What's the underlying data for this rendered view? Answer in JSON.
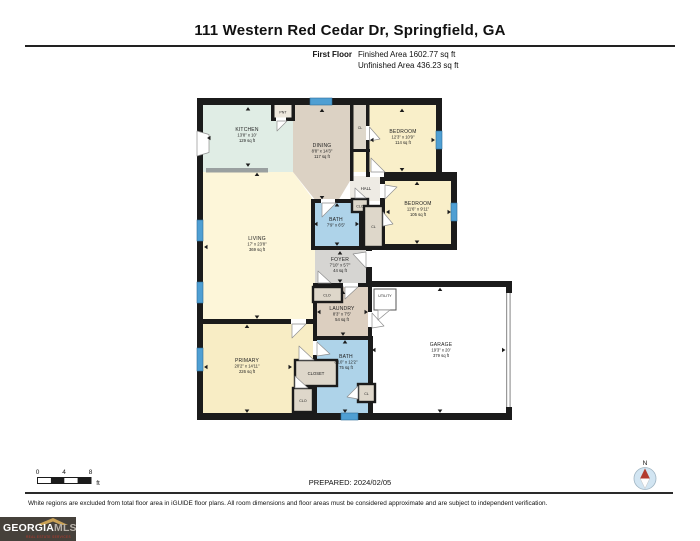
{
  "header": {
    "title": "111 Western Red Cedar Dr, Springfield, GA",
    "floor_label": "First Floor",
    "finished_area": "Finished Area 1602.77 sq ft",
    "unfinished_area": "Unfinished Area 436.23 sq ft"
  },
  "rooms": {
    "kitchen": {
      "name": "KITCHEN",
      "dims": "13'8\" x 10'",
      "area": "129 sq ft"
    },
    "pantry": {
      "name": "PNT"
    },
    "dining": {
      "name": "DINING",
      "dims": "8'8\" x 14'3\"",
      "area": "117 sq ft"
    },
    "closet_top": {
      "name": "CL"
    },
    "bedroom1": {
      "name": "BEDROOM",
      "dims": "12'3\" x 10'9\"",
      "area": "114 sq ft"
    },
    "hall": {
      "name": "HALL"
    },
    "clo_hall": {
      "name": "CLO"
    },
    "bath1": {
      "name": "BATH",
      "dims": "7'9\" x 6'5\""
    },
    "closet_bed2": {
      "name": "CL"
    },
    "bedroom2": {
      "name": "BEDROOM",
      "dims": "11'6\" x 9'11\"",
      "area": "105 sq ft"
    },
    "living": {
      "name": "LIVING",
      "dims": "17' x 23'8\"",
      "area": "369 sq ft"
    },
    "foyer": {
      "name": "FOYER",
      "dims": "7'10\" x 5'7\"",
      "area": "44 sq ft"
    },
    "clo_foyer": {
      "name": "CLO"
    },
    "laundry": {
      "name": "LAUNDRY",
      "dims": "8'3\" x 7'5\"",
      "area": "54 sq ft"
    },
    "utility": {
      "name": "UTILITY"
    },
    "garage": {
      "name": "GARAGE",
      "dims": "19'3\" x 20'",
      "area": "379 sq ft"
    },
    "primary": {
      "name": "PRIMARY",
      "dims": "20'2\" x 14'11\"",
      "area": "226 sq ft"
    },
    "closet_primary": {
      "name": "CLOSET"
    },
    "clo_primary": {
      "name": "CLO"
    },
    "bath2": {
      "name": "BATH",
      "dims": "8'10\" x 12'2\"",
      "area": "75 sq ft"
    },
    "cl_bath2": {
      "name": "CL"
    }
  },
  "scale_bar": {
    "labels": [
      "0",
      "4",
      "8"
    ],
    "unit": "ft"
  },
  "footer": {
    "prepared": "PREPARED: 2024/02/05",
    "compass_label": "N",
    "disclaimer": "White regions are excluded from total floor area in iGUIDE floor plans. All room dimensions and floor areas must be considered approximate and are subject to independent verification.",
    "logo": {
      "brand_primary": "GEORGIA",
      "brand_secondary": "MLS",
      "tagline": "REAL ESTATE SERVICES"
    }
  },
  "colors": {
    "wall": "#1b1b1b",
    "kitchen": "#e0ede5",
    "dining": "#dcd2c4",
    "bedroom": "#f9efc9",
    "living": "#fdf6d9",
    "primary": "#f8edc5",
    "bath": "#aed3e9",
    "foyer": "#d6d5d2",
    "hall": "#eeebe4",
    "closet": "#ded7ca",
    "laundry": "#dccfc0",
    "pantry": "#eee8dd",
    "window": "#4f9fd3",
    "counter": "#9aa0a0",
    "compass_needle": "#b23b2e",
    "logo_bg": "#46413b",
    "logo_gold": "#c9a156",
    "logo_red": "#c0392b"
  }
}
